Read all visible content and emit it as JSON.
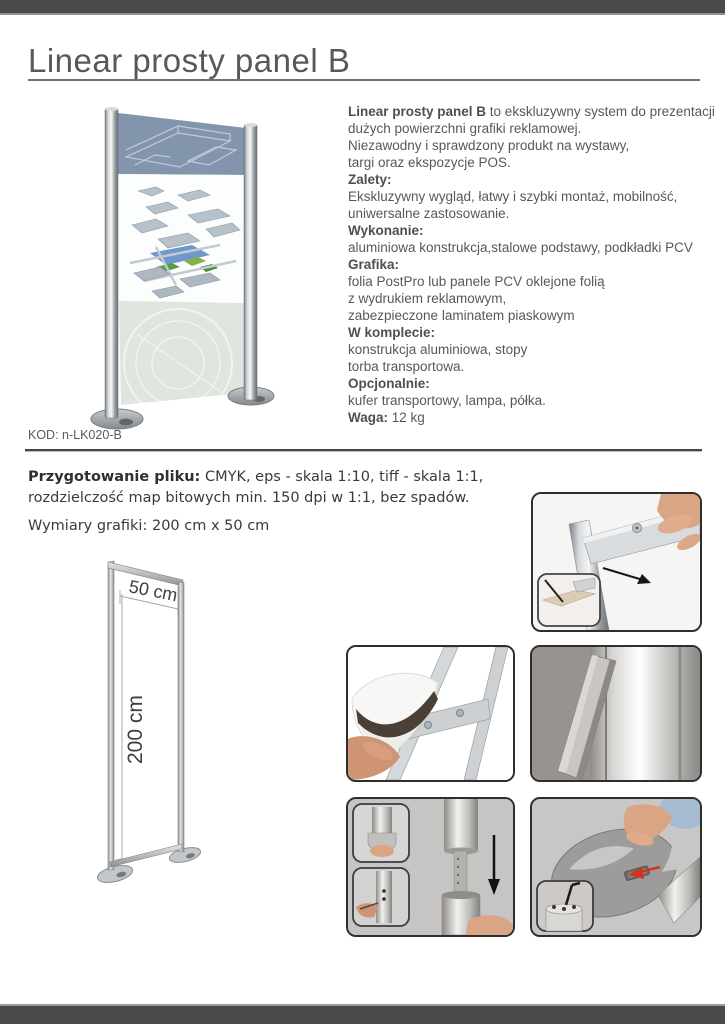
{
  "page": {
    "title": "Linear prosty panel B",
    "code": "KOD: n-LK020-B"
  },
  "colors": {
    "bar": "#4a4a4b",
    "title": "#58585a",
    "panel_blue": "#8295ac",
    "panel_green": "#dfe6e0",
    "accent_red": "#d23320",
    "skin": "#d9a584",
    "sleeve": "#a6bcd3"
  },
  "description": {
    "lines": [
      [
        {
          "b": 1,
          "t": "Linear prosty panel B"
        },
        {
          "t": " to ekskluzywny system do prezentacji"
        }
      ],
      [
        {
          "t": "dużych powierzchni grafiki reklamowej."
        }
      ],
      [
        {
          "t": "Niezawodny i sprawdzony produkt na wystawy,"
        }
      ],
      [
        {
          "t": "targi oraz ekspozycje POS."
        }
      ],
      [
        {
          "b": 1,
          "t": "Zalety:"
        }
      ],
      [
        {
          "t": "Ekskluzywny wygląd, łatwy i szybki montaż, mobilność,"
        }
      ],
      [
        {
          "t": "uniwersalne zastosowanie."
        }
      ],
      [
        {
          "b": 1,
          "t": "Wykonanie:"
        }
      ],
      [
        {
          "t": "aluminiowa konstrukcja,stalowe podstawy, podkładki PCV"
        }
      ],
      [
        {
          "b": 1,
          "t": "Grafika:"
        }
      ],
      [
        {
          "t": "folia PostPro lub panele PCV oklejone folią"
        }
      ],
      [
        {
          "t": "z wydrukiem reklamowym,"
        }
      ],
      [
        {
          "t": "zabezpieczone laminatem piaskowym"
        }
      ],
      [
        {
          "b": 1,
          "t": "W komplecie:"
        }
      ],
      [
        {
          "t": "konstrukcja aluminiowa, stopy"
        }
      ],
      [
        {
          "t": "torba transportowa."
        }
      ],
      [
        {
          "b": 1,
          "t": "Opcjonalnie:"
        }
      ],
      [
        {
          "t": "kufer transportowy,  lampa, półka."
        }
      ],
      [
        {
          "b": 1,
          "t": "Waga:"
        },
        {
          "t": " 12 kg"
        }
      ]
    ]
  },
  "specs": {
    "file_prep_label": "Przygotowanie pliku:",
    "file_prep_rest": " CMYK, eps - skala 1:10, tiff - skala 1:1,",
    "file_prep_line2": "rozdzielczość map bitowych min. 150 dpi w 1:1, bez spadów.",
    "dims_label": "Wymiary grafiki:",
    "dims_value": " 200 cm x 50 cm"
  },
  "diagram": {
    "width_label": "50 cm",
    "height_label": "200 cm"
  }
}
